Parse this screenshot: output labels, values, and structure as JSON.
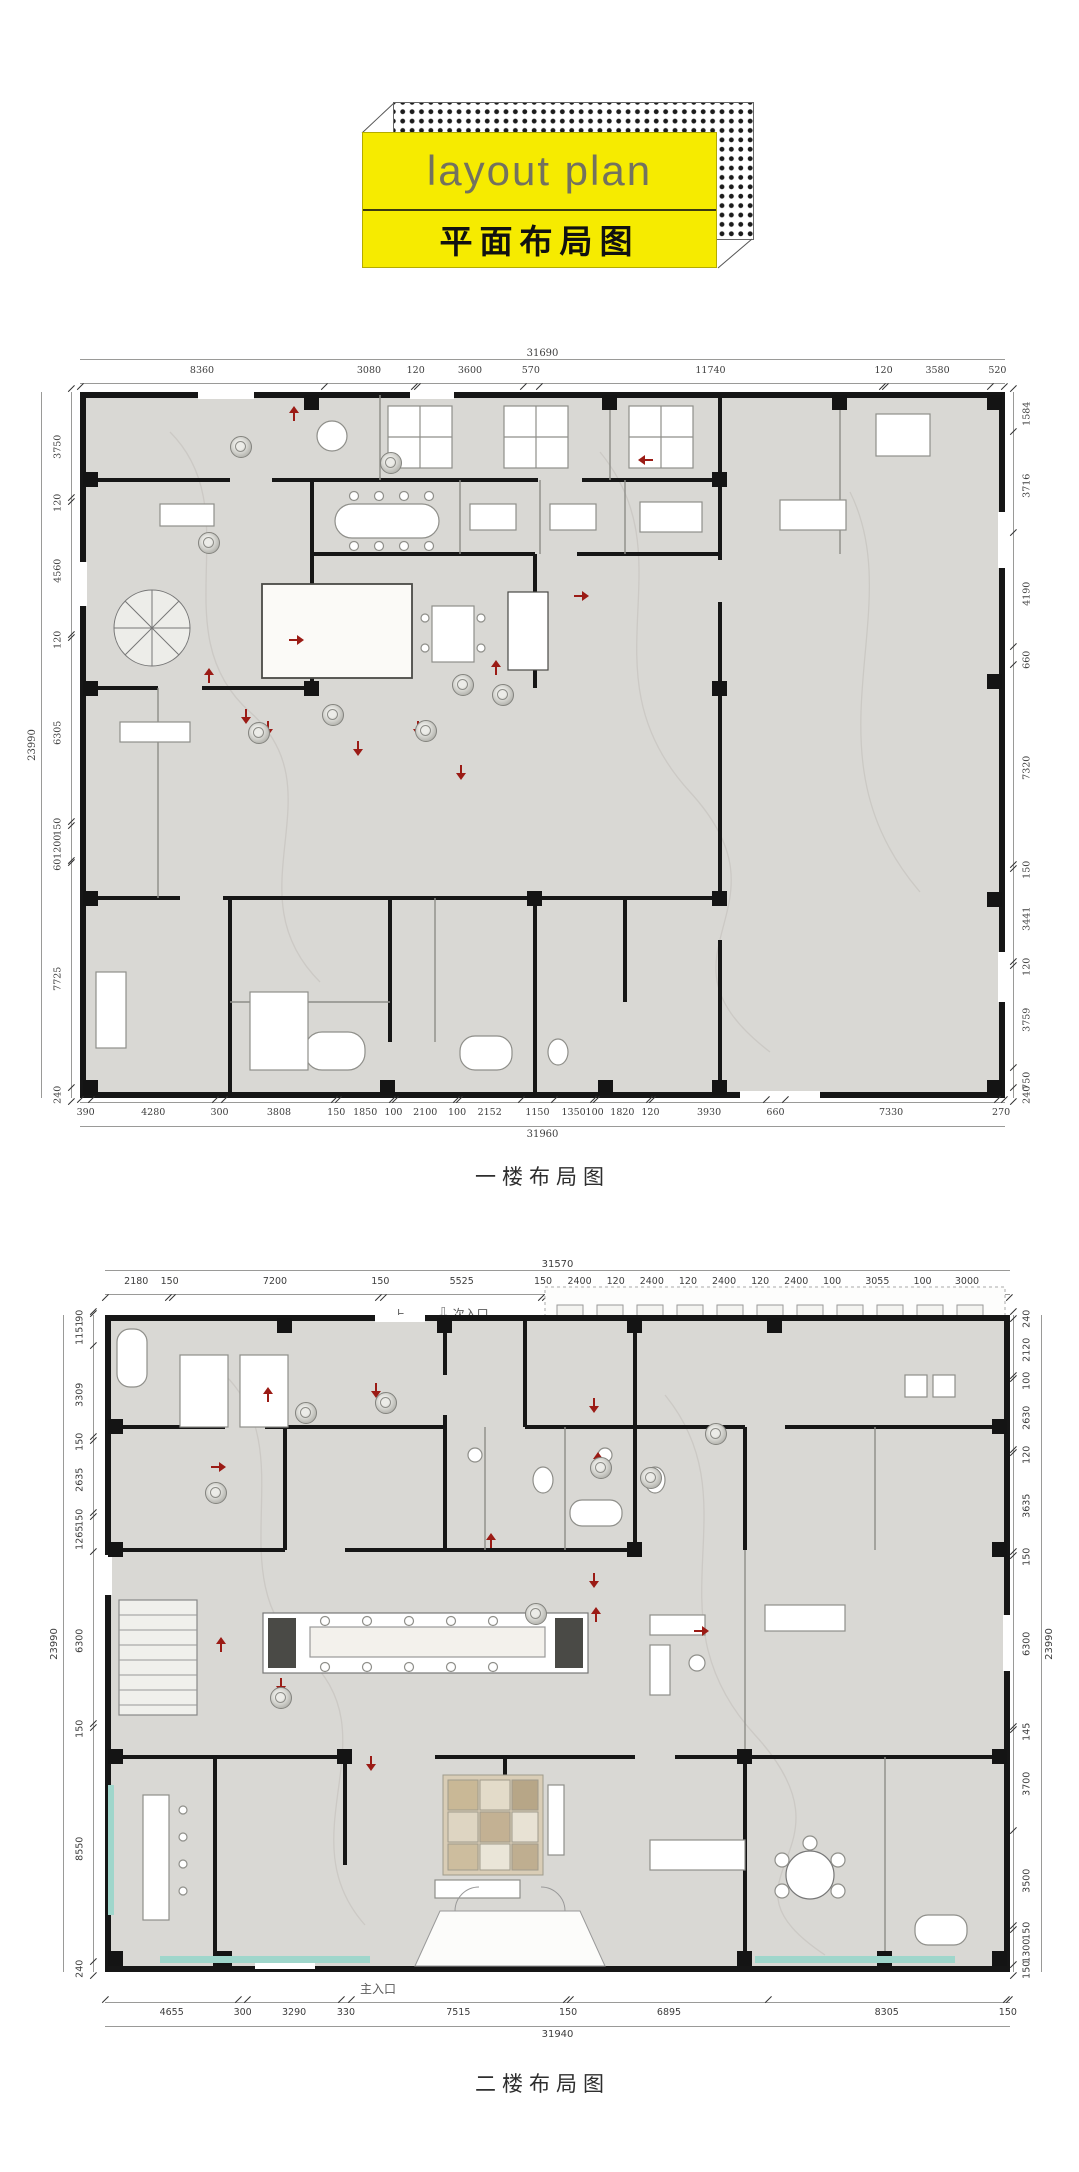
{
  "title_block": {
    "title_en": "layout plan",
    "title_zh": "平面布局图",
    "banner_color": "#f6eb00",
    "dot_color": "#1b1b1b"
  },
  "plan1": {
    "caption": "一楼布局图",
    "top_total": "31690",
    "top_dims": [
      8360,
      3080,
      120,
      3600,
      570,
      11740,
      120,
      3580,
      520
    ],
    "bottom_total": "31960",
    "bottom_dims": [
      390,
      4280,
      300,
      3808,
      150,
      1850,
      100,
      2100,
      100,
      2152,
      1150,
      1350,
      100,
      1820,
      120,
      3930,
      660,
      7330,
      270
    ],
    "left_total": "23990",
    "left_dims": [
      3750,
      120,
      4560,
      120,
      6305,
      150,
      1200,
      60,
      7725,
      240
    ],
    "right_dims": [
      1584,
      3716,
      4190,
      660,
      7320,
      150,
      3441,
      120,
      3759,
      750,
      240
    ]
  },
  "plan2": {
    "caption": "二楼布局图",
    "top_total": "31570",
    "top_dims": [
      2180,
      150,
      7200,
      150,
      5525,
      150,
      2400,
      120,
      2400,
      120,
      2400,
      120,
      2400,
      100,
      3055,
      100,
      3000
    ],
    "bottom_total": "31940",
    "bottom_dims": [
      4655,
      300,
      3290,
      330,
      7515,
      150,
      6895,
      8305,
      150
    ],
    "left_total": "23990",
    "left_dims": [
      90,
      1151,
      3309,
      150,
      2635,
      150,
      1265,
      6300,
      150,
      8550,
      240
    ],
    "right_total": "23990",
    "right_dims": [
      240,
      2120,
      100,
      2630,
      120,
      3635,
      150,
      6300,
      145,
      3700,
      3500,
      150,
      1300,
      150
    ],
    "labels": {
      "up": "上",
      "secondary_entrance": "次入口",
      "ac_unit": "空调外机",
      "main_entrance": "主入口"
    }
  },
  "icons": {
    "entrance_arrow_glyph": "⇩",
    "flow_arrow_color": "#9b1b15"
  },
  "colors": {
    "wall": "#161616",
    "floor": "#d9d8d4",
    "teal_accent": "#9fd6cb",
    "dimension_text": "#3d3d3d"
  }
}
